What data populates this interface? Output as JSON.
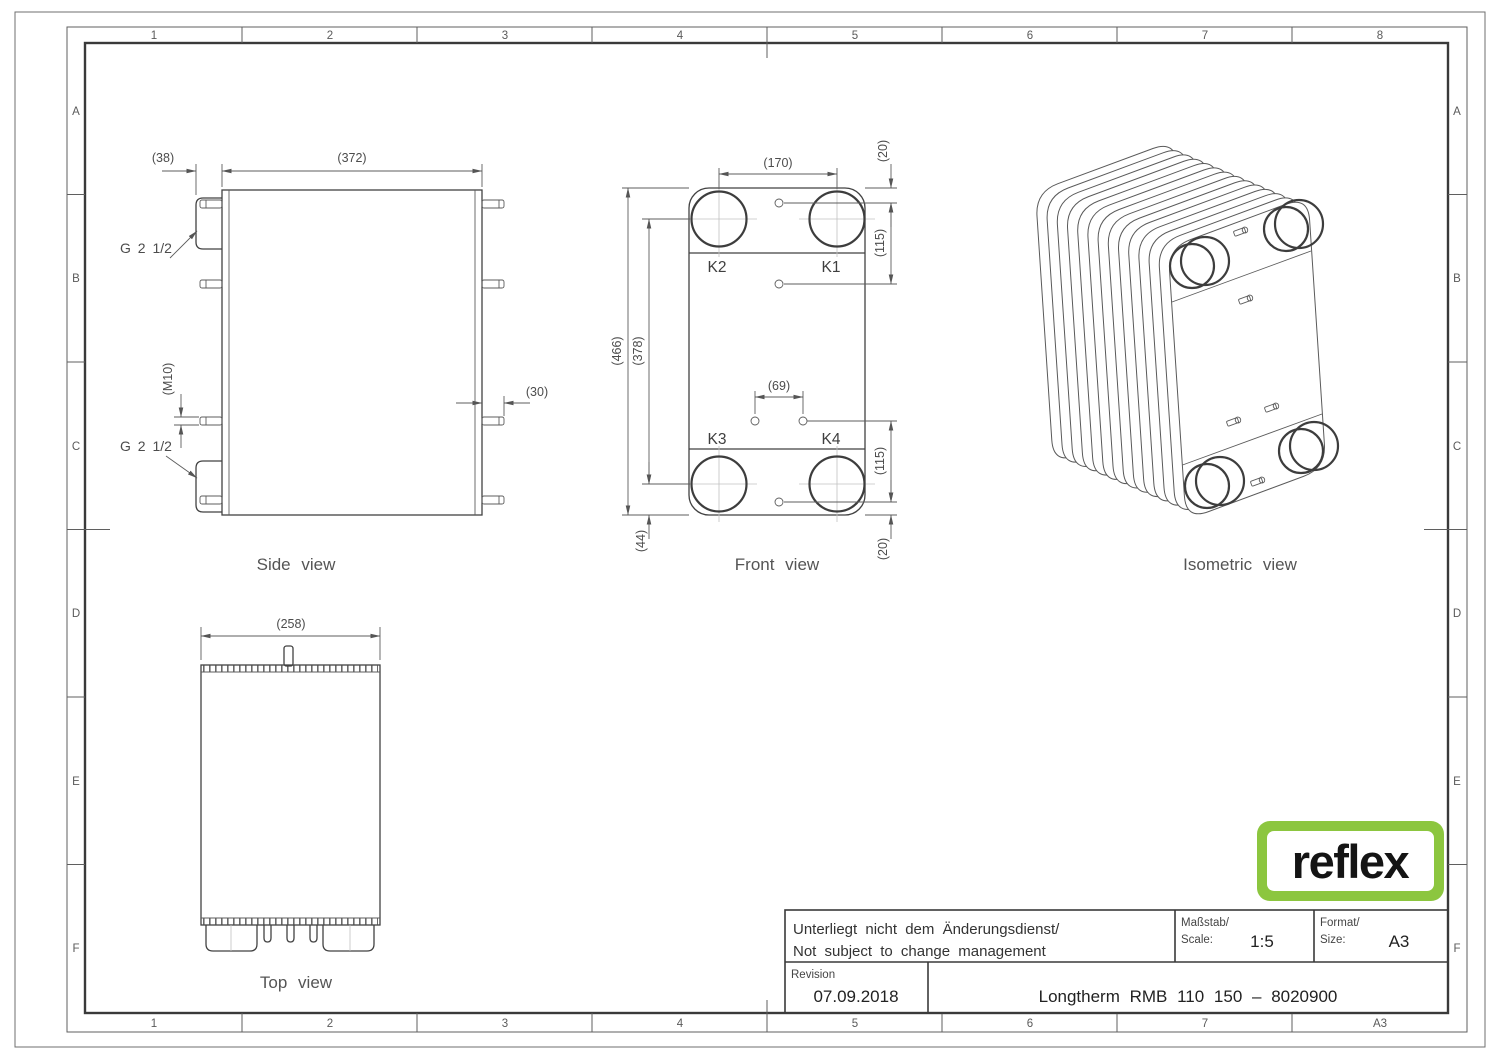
{
  "border": {
    "columns_top": [
      "1",
      "2",
      "3",
      "4",
      "5",
      "6",
      "7",
      "8"
    ],
    "columns_bottom": [
      "1",
      "2",
      "3",
      "4",
      "5",
      "6",
      "7",
      "A3"
    ],
    "rows": [
      "A",
      "B",
      "C",
      "D",
      "E",
      "F"
    ]
  },
  "drawing": {
    "captions": {
      "side": "Side view",
      "front": "Front view",
      "top": "Top view",
      "iso": "Isometric view"
    },
    "side": {
      "dim_38": "(38)",
      "dim_372": "(372)",
      "dim_m10": "(M10)",
      "dim_30": "(30)",
      "conn_top": "G 2 1/2",
      "conn_bottom": "G 2 1/2"
    },
    "front": {
      "dim_170": "(170)",
      "dim_20_top": "(20)",
      "dim_115_top": "(115)",
      "dim_466": "(466)",
      "dim_378": "(378)",
      "dim_69": "(69)",
      "dim_115_bottom": "(115)",
      "dim_44": "(44)",
      "dim_20_bottom": "(20)",
      "port_k1": "K1",
      "port_k2": "K2",
      "port_k3": "K3",
      "port_k4": "K4"
    },
    "top": {
      "dim_258": "(258)"
    }
  },
  "title_block": {
    "note_de": "Unterliegt nicht dem Änderungsdienst/",
    "note_en": "Not subject to change management",
    "scale_label": "Maßstab/",
    "scale_sublabel": "Scale:",
    "scale_value": "1:5",
    "format_label": "Format/",
    "format_sublabel": "Size:",
    "format_value": "A3",
    "revision_label": "Revision",
    "revision_date": "07.09.2018",
    "part_title": "Longtherm RMB 110 150 – 8020900"
  },
  "logo": {
    "text": "reflex",
    "green": "#8CC63F"
  }
}
